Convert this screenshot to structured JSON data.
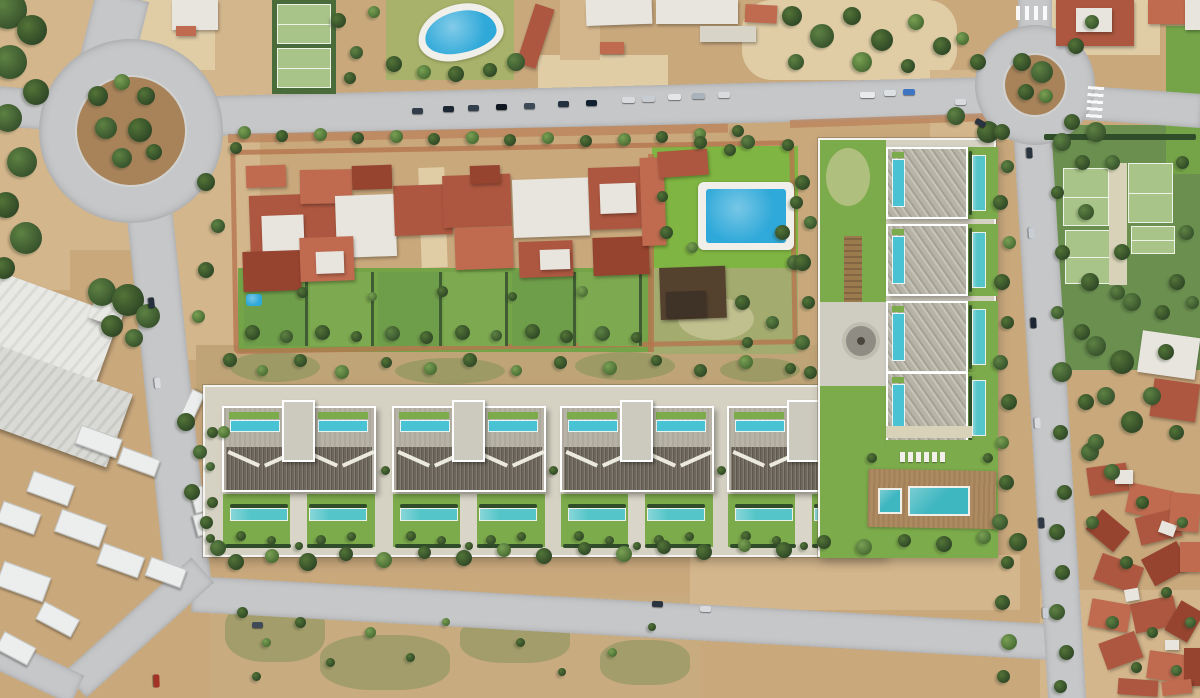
{
  "scene": {
    "type": "aerial-drone-photograph",
    "description": "Top-down aerial view of a Mediterranean coastal neighborhood: an existing red-roofed residential compound with garden pools, two tree-filled roundabouts joined by roads, scrubland, and a new modern villa development (rendered) with rooftop pools, slatted pergolas, lawns and turquoise lap pools, plus tennis courts and dense red-roofed houses at right",
    "features": {
      "roundabouts": 2,
      "twin_villa_blocks_row": 4,
      "villas_right_column": 4,
      "tennis_courts": 4,
      "kidney_shaped_pool": 1,
      "rectangular_garden_pool": 1,
      "communal_pools": 2,
      "rooftop_pools": 12,
      "lap_pools": 12
    }
  },
  "palette": {
    "sand": "#c9a87c",
    "sand_light": "#d4b68c",
    "sand_pale": "#e0cda6",
    "road": "#c6c7c9",
    "dirt_island": "#a8835a",
    "lawn": "#74a348",
    "lawn_bright": "#7fb542",
    "cgi_lawn": "#7cab4b",
    "pool_blue": "#2fa9d9",
    "pool_teal": "#49c2d4",
    "pool_lap": "#54c5c8",
    "roof_red": "#ad5740",
    "roof_red_dark": "#96432f",
    "roof_red_light": "#c06b50",
    "roof_white": "#e8e5df",
    "gravel": "#b7b3a6",
    "pergola": "#6e675c",
    "deck": "#ad8a60",
    "hedge": "#2f4d28",
    "path_red": "#b5764f",
    "wall_white": "#f4f3ef"
  }
}
